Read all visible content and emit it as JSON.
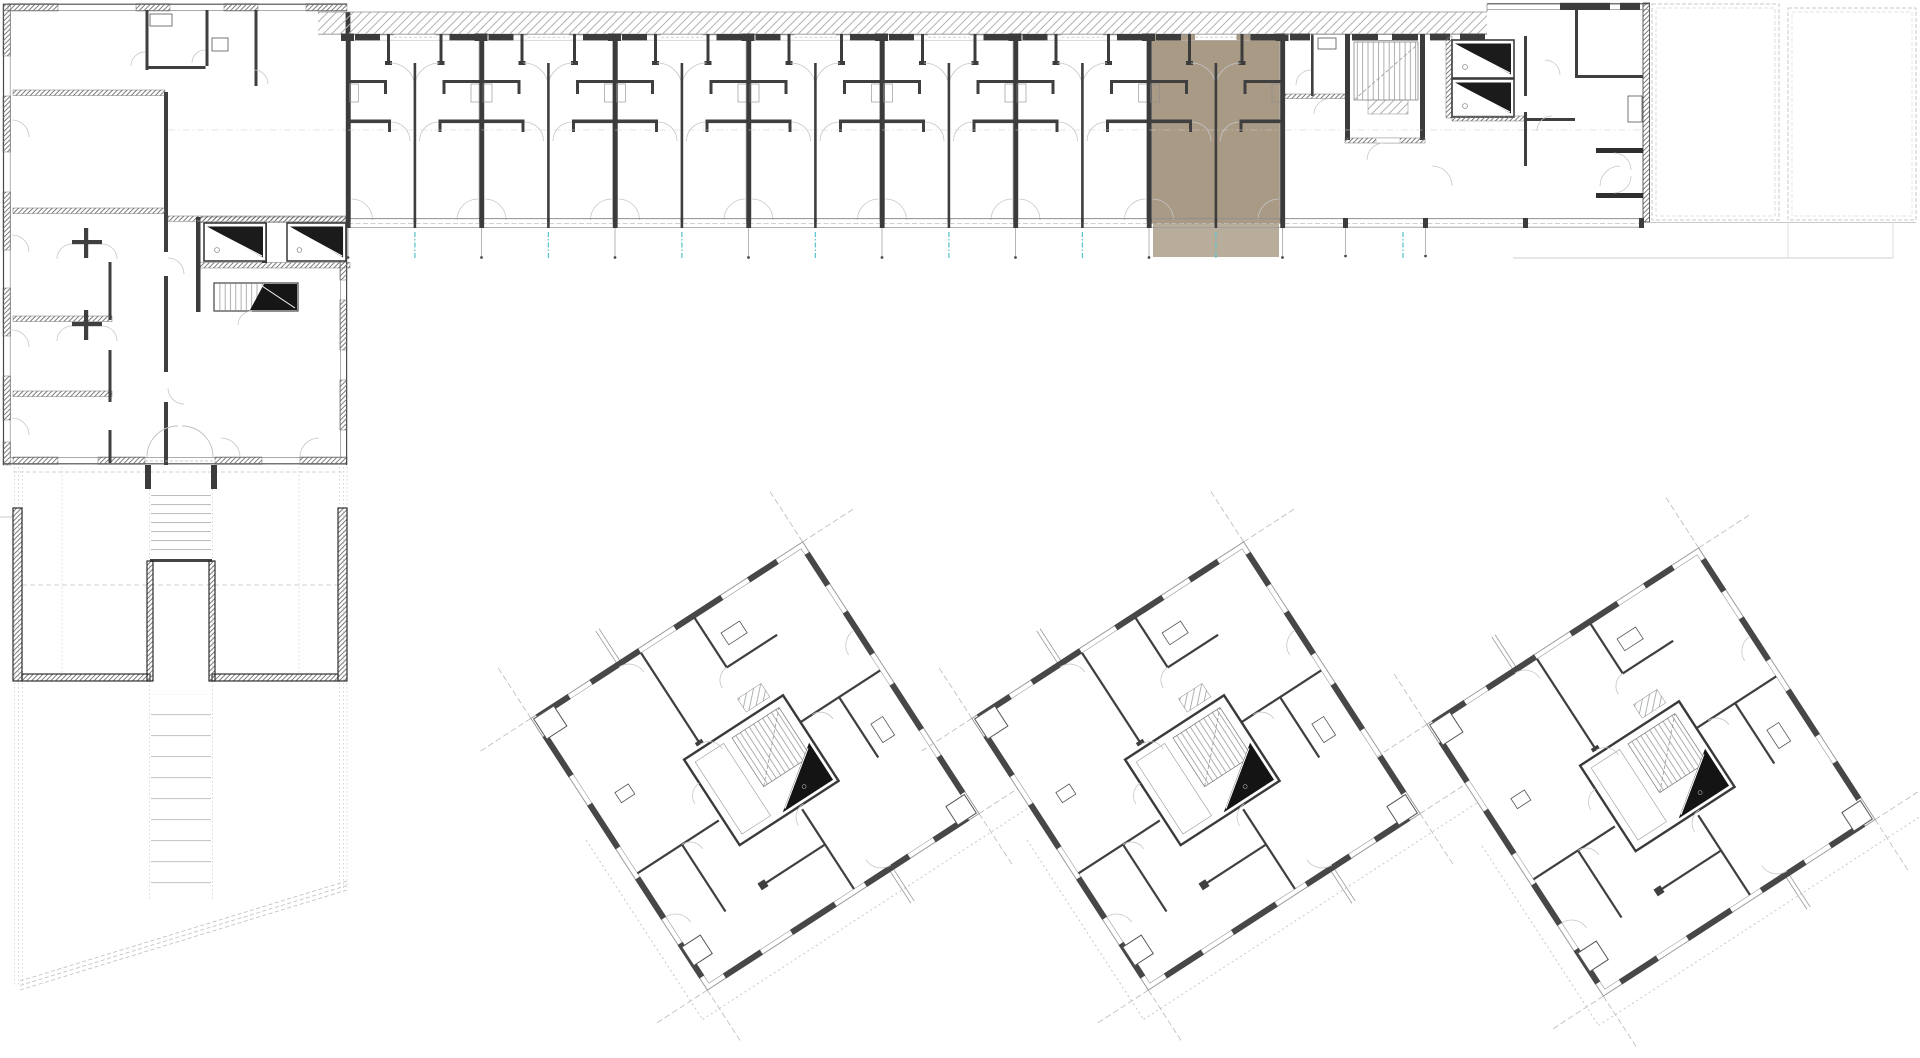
{
  "document": {
    "type": "architectural site and floor plan drawing",
    "text_labels": []
  },
  "colors": {
    "background": "#ffffff",
    "highlight": "#a89a85",
    "highlight_wall": "#5f564a",
    "teal_mark": "#5fc6cc",
    "wall_dark": "#3b3b3b",
    "line_mid": "#8f8f8f",
    "line_light": "#c6c6c6",
    "ghost_outline": "#c8c8c8"
  },
  "buildings": {
    "gallery_wing": {
      "unit_modules": 7,
      "studios_per_module": 2,
      "highlighted_module": 7,
      "access_gallery_hatched": true,
      "stair_cores": 1,
      "elevator_shafts": 2
    },
    "left_block": {
      "elevator_shafts": 2,
      "stair_cores": 1
    },
    "square_towers": {
      "count": 3,
      "rotation_deg": -33,
      "stair_core_per_tower": 1,
      "elevator_per_tower": 1
    },
    "neighbor_outlines_right": 2
  },
  "site": {
    "exterior_stair_flights": 2,
    "dashed_boundary": true,
    "courtyard_retaining_walls": true
  },
  "icons": {
    "elevator": "elevator-wedge-icon",
    "stair": "stair-treads-icon",
    "door": "door-swing-arc-icon"
  }
}
